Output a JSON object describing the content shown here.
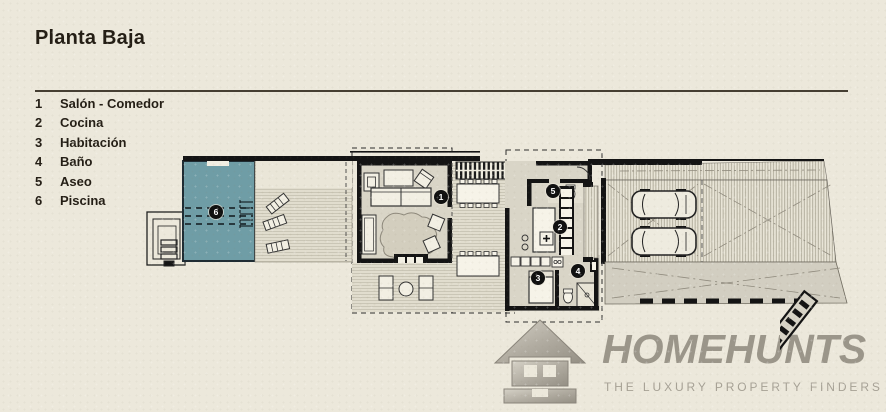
{
  "page": {
    "title": "Planta Baja"
  },
  "legend": {
    "items": [
      {
        "num": "1",
        "label": "Salón - Comedor"
      },
      {
        "num": "2",
        "label": "Cocina"
      },
      {
        "num": "3",
        "label": "Habitación"
      },
      {
        "num": "4",
        "label": "Baño"
      },
      {
        "num": "5",
        "label": "Aseo"
      },
      {
        "num": "6",
        "label": "Piscina"
      }
    ]
  },
  "plan": {
    "markers": [
      "1",
      "2",
      "3",
      "4",
      "5",
      "6"
    ]
  },
  "logo": {
    "name": "HOMEHUNTS",
    "tagline": "THE LUXURY PROPERTY FINDERS"
  },
  "colors": {
    "pool": "#6f9da6",
    "paper": "#ece8db",
    "ink": "#241e15",
    "logo_gray": "#9b968a"
  }
}
